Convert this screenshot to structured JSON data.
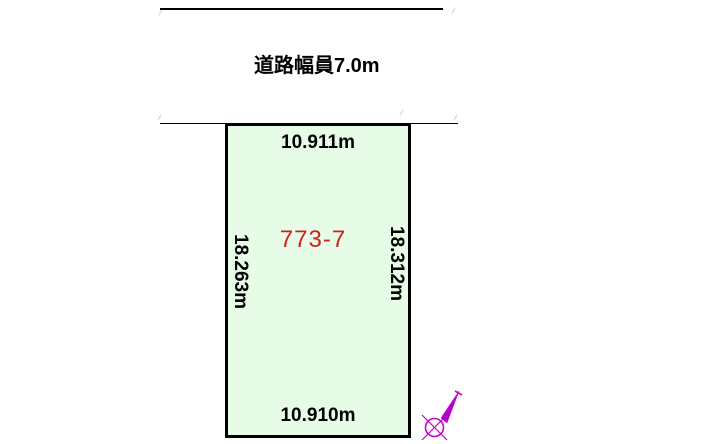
{
  "road": {
    "label": "道路幅員7.0m"
  },
  "parcel": {
    "number": "773-7",
    "dimensions": {
      "top": "10.911m",
      "bottom": "10.910m",
      "left": "18.263m",
      "right": "18.312m"
    }
  },
  "icons": {
    "north_arrow": "north-arrow-icon"
  },
  "colors": {
    "background": "#ffffff",
    "parcel_fill": "#e6fce6",
    "parcel_border": "#000000",
    "parcel_number_text": "#cc2222",
    "dimension_text": "#000000",
    "north_arrow": "#cc00cc"
  }
}
